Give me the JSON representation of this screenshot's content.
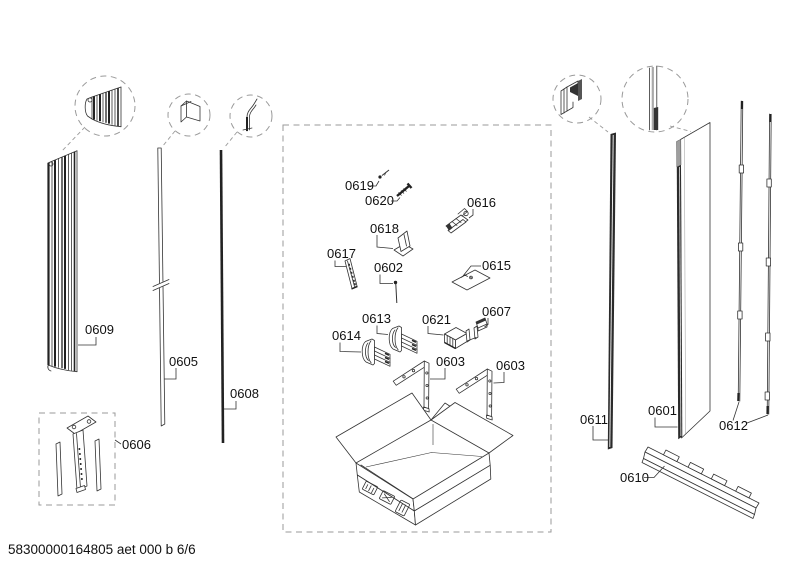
{
  "page": {
    "footer_code": "58300000164805 aet 000 b 6/6",
    "background_color": "#ffffff",
    "line_color": "#333333",
    "dash_color": "#9a9a9a",
    "label_color": "#111111"
  },
  "labels": {
    "p0601": "0601",
    "p0602": "0602",
    "p0603_left": "0603",
    "p0603_right": "0603",
    "p0605": "0605",
    "p0606": "0606",
    "p0607": "0607",
    "p0608": "0608",
    "p0609": "0609",
    "p0610": "0610",
    "p0611": "0611",
    "p0612": "0612",
    "p0613": "0613",
    "p0614": "0614",
    "p0615": "0615",
    "p0616": "0616",
    "p0617": "0617",
    "p0618": "0618",
    "p0619": "0619",
    "p0620": "0620",
    "p0621": "0621"
  }
}
